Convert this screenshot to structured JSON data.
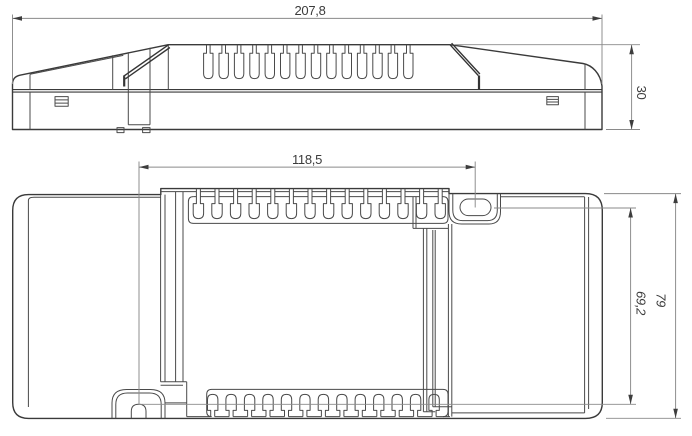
{
  "dimensions": {
    "overall_length": "207,8",
    "overall_height": "30",
    "feature_spacing": "118,5",
    "hole_to_notch": "69,2",
    "overall_width": "79"
  },
  "views": {
    "side": {
      "vent_slots": 14
    },
    "plan": {
      "vent_slots_top": 14,
      "vent_slots_bottom": 13
    }
  },
  "colors": {
    "line": "#3a3a3a",
    "dimension": "#8a8a8a",
    "text": "#3c3c3c"
  }
}
